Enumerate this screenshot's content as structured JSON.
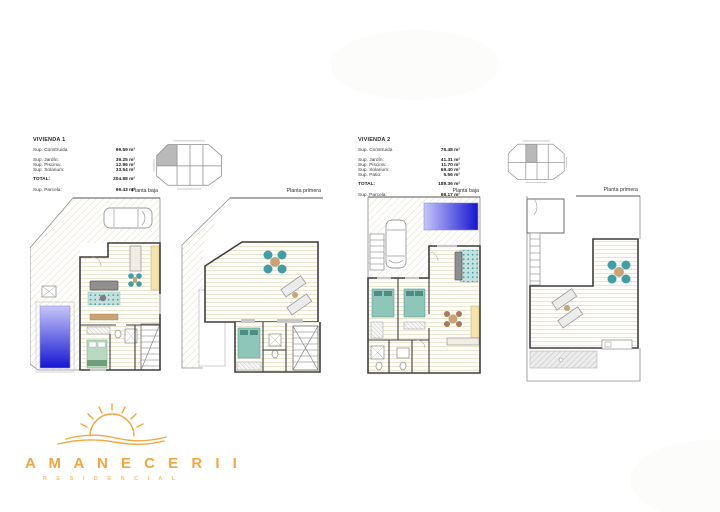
{
  "document": {
    "type": "residential floor-plan sheet"
  },
  "palette": {
    "wall": "#3f3f3f",
    "teal": "#3f9fa5",
    "wood": "#c9a377",
    "chair-brown": "#a9795a",
    "counter": "#f5e3a9",
    "bed-green": "#b9d9c0",
    "bed-teal": "#8ec6ba",
    "pool-light": "#c6c6fa",
    "pool-dark": "#1515d2",
    "shaded": "#b9b9b9",
    "orange": "#F2A63F",
    "orange-light": "#F4BE77",
    "floor-line": "#e7e0c9",
    "hatch-line": "#e3dcc3"
  },
  "units": [
    {
      "title": "VIVIENDA 1",
      "specs": [
        {
          "label": "Sup. Construida",
          "value": "99.59 m²"
        },
        {
          "label": "Sup. Jardín:",
          "value": "39.25 m²"
        },
        {
          "label": "Sup. Piscina:",
          "value": "12.96 m²"
        },
        {
          "label": "Sup. Solarium:",
          "value": "33.54 m²"
        }
      ],
      "total": {
        "label": "TOTAL:",
        "value": "204.88 m²"
      },
      "parcela": {
        "label": "Sup. Parcela:",
        "value": "99.43 m²"
      },
      "floors": [
        {
          "label": "Planta baja"
        },
        {
          "label": "Planta primera"
        }
      ],
      "key_plan": {
        "rows": 2,
        "cols": 4,
        "highlighted_cell": 1
      }
    },
    {
      "title": "VIVIENDA 2",
      "specs": [
        {
          "label": "Sup. Construida",
          "value": "76.48 m²"
        },
        {
          "label": "Sup. Jardín:",
          "value": "41.31 m²"
        },
        {
          "label": "Sup. Piscina:",
          "value": "11.70 m²"
        },
        {
          "label": "Sup. Solarium:",
          "value": "69.40 m²"
        },
        {
          "label": "Sup. Patio:",
          "value": "5.56 m²"
        }
      ],
      "total": {
        "label": "TOTAL:",
        "value": "189.36 m²"
      },
      "parcela": {
        "label": "Sup. Parcela:",
        "value": "98.17 m²"
      },
      "floors": [
        {
          "label": "Planta baja"
        },
        {
          "label": "Planta primera"
        }
      ],
      "key_plan": {
        "rows": 2,
        "cols": 4,
        "highlighted_cell": 2
      }
    }
  ],
  "logo": {
    "name": "A M A N E C E R I I",
    "subtitle": "R E S I D E N C I A L"
  }
}
